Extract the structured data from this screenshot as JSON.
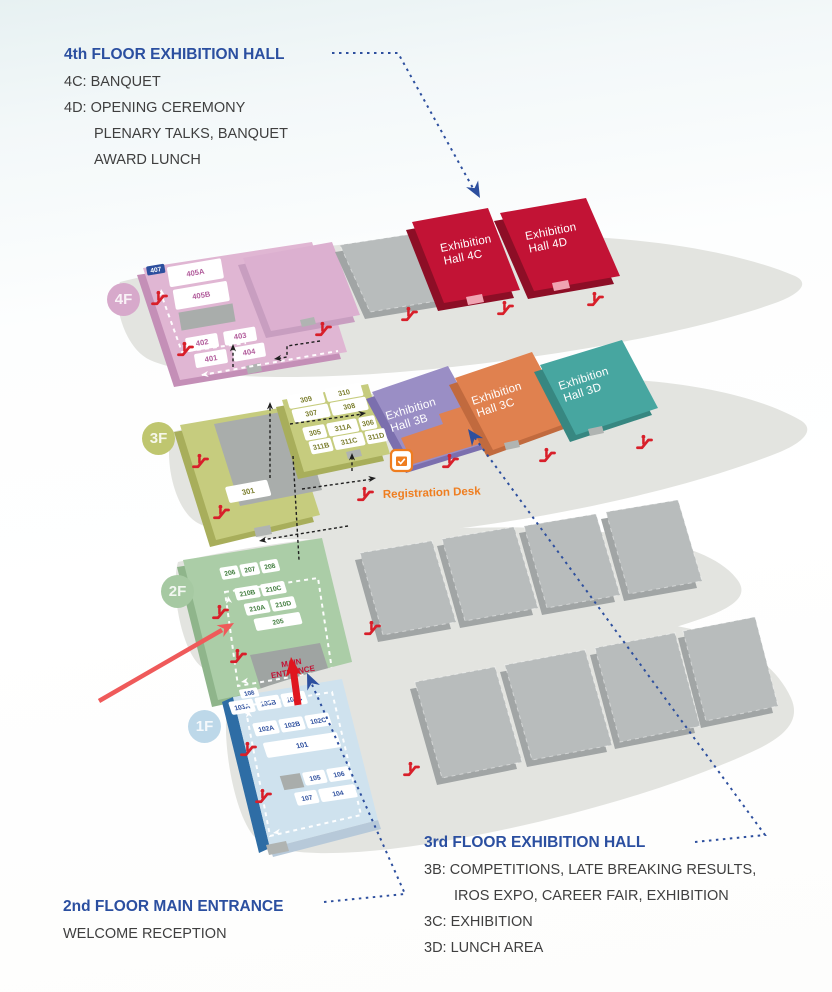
{
  "notes": {
    "floor4": {
      "title": "4th FLOOR EXHIBITION HALL",
      "line1": "4C: BANQUET",
      "line2": "4D: OPENING CEREMONY",
      "line3": "PLENARY TALKS, BANQUET",
      "line4": "AWARD LUNCH"
    },
    "floor3": {
      "title": "3rd FLOOR EXHIBITION HALL",
      "line1": "3B: COMPETITIONS, LATE BREAKING RESULTS,",
      "line2": "IROS EXPO, CAREER FAIR, EXHIBITION",
      "line3": "3C: EXHIBITION",
      "line4": "3D: LUNCH AREA"
    },
    "floor2": {
      "title": "2nd FLOOR MAIN ENTRANCE",
      "line1": "WELCOME RECEPTION"
    }
  },
  "floors": {
    "f4": {
      "badge": "4F",
      "rooms": [
        "407",
        "405A",
        "405B",
        "402",
        "403",
        "401",
        "404"
      ],
      "halls": {
        "c": [
          "Exhibition",
          "Hall 4C"
        ],
        "d": [
          "Exhibition",
          "Hall 4D"
        ]
      }
    },
    "f3": {
      "badge": "3F",
      "rooms": [
        "309",
        "310",
        "307",
        "308",
        "305",
        "311A",
        "306",
        "311B",
        "311C",
        "311D",
        "301"
      ],
      "halls": {
        "b": [
          "Exhibition",
          "Hall 3B"
        ],
        "c": [
          "Exhibition",
          "Hall 3C"
        ],
        "d": [
          "Exhibition",
          "Hall 3D"
        ]
      }
    },
    "f2": {
      "badge": "2F",
      "rooms": [
        "206",
        "207",
        "208",
        "210B",
        "210C",
        "210A",
        "210D",
        "205"
      ],
      "entrance": [
        "MAIN",
        "ENTRANCE"
      ]
    },
    "f1": {
      "badge": "1F",
      "rooms": [
        "108",
        "103A",
        "103B",
        "103C",
        "102A",
        "102B",
        "102C",
        "101",
        "105",
        "106",
        "107",
        "104"
      ]
    }
  },
  "registration_desk": "Registration Desk",
  "colors": {
    "heading_blue": "#2b4fa0",
    "body_text": "#3f3f3f",
    "hall_crimson": "#c21335",
    "hall_purple": "#9a8ec5",
    "hall_orange": "#e0814f",
    "hall_teal": "#47a6a0",
    "floor_pink": "#e0b6d3",
    "floor_olive": "#c6cc7e",
    "floor_green": "#abcda7",
    "floor_lightblue": "#cfe2ee",
    "escalator_red": "#d81f2a",
    "entrance_arrow_red": "#e0161f",
    "pointer_arrow_coral": "#ef5a5a",
    "registration_orange": "#ef7d1f",
    "room_text_pink": "#b25d9c",
    "room_text_olive": "#7c7f2f",
    "room_text_green": "#3f7c3c",
    "room_text_navy": "#2d4f9e"
  }
}
